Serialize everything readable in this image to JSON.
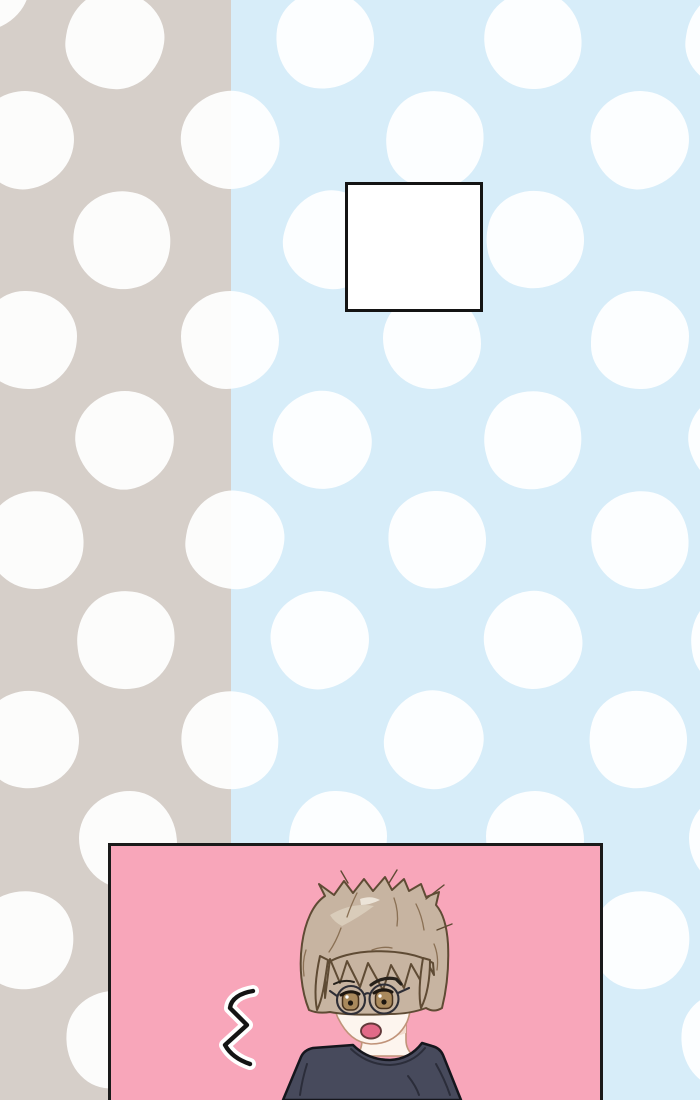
{
  "colors": {
    "bg-left": "#d6cfc9",
    "bg-right": "#d7edf9",
    "dot": "rgba(255,255,255,0.93)",
    "caption-fill": "#ffffff",
    "caption-border": "#141414",
    "panel-bg": "#f8a6ba",
    "panel-border": "#1a1a1a",
    "skin": "#fdf5ee",
    "skin-shadow": "#f2dcce",
    "face-line": "#c09379",
    "hair": "#c7b4a1",
    "hair-light": "#d9ccba",
    "hair-gleam": "#ece4d8",
    "hair-stroke": "#8a7054",
    "hair-outline": "#5f4b34",
    "iris": "#a9895c",
    "iris-outline": "#45301c",
    "lash": "#1e1710",
    "brow": "#26211b",
    "glasses": "#2e2e36",
    "mouth": "#e26a88",
    "mouth-outline": "#63393a",
    "shirt": "#474a5c",
    "shirt-fold": "#2b2d3a",
    "shirt-outline": "#15161d",
    "squiggle": "#141414",
    "squiggle-halo": "#ffffff"
  },
  "background": {
    "divider_x": 231,
    "dot_diameter": 98,
    "dot_rows": [
      {
        "y": -18,
        "xs": [
          -20
        ]
      },
      {
        "y": 40,
        "xs": [
          115,
          325,
          533,
          735
        ]
      },
      {
        "y": 140,
        "xs": [
          25,
          230,
          435,
          640
        ]
      },
      {
        "y": 240,
        "xs": [
          122,
          333,
          535
        ]
      },
      {
        "y": 340,
        "xs": [
          28,
          230,
          432,
          640
        ]
      },
      {
        "y": 440,
        "xs": [
          125,
          322,
          533,
          738
        ]
      },
      {
        "y": 540,
        "xs": [
          35,
          235,
          437,
          640
        ]
      },
      {
        "y": 640,
        "xs": [
          126,
          320,
          533,
          740
        ]
      },
      {
        "y": 740,
        "xs": [
          30,
          230,
          434,
          638
        ]
      },
      {
        "y": 840,
        "xs": [
          128,
          338,
          535,
          738
        ]
      },
      {
        "y": 940,
        "xs": [
          25,
          230,
          435,
          641
        ]
      },
      {
        "y": 1040,
        "xs": [
          115,
          325,
          533,
          730
        ]
      }
    ]
  },
  "panel": {
    "contents": "anime boy with glasses, surprised expression, shock squiggle"
  }
}
